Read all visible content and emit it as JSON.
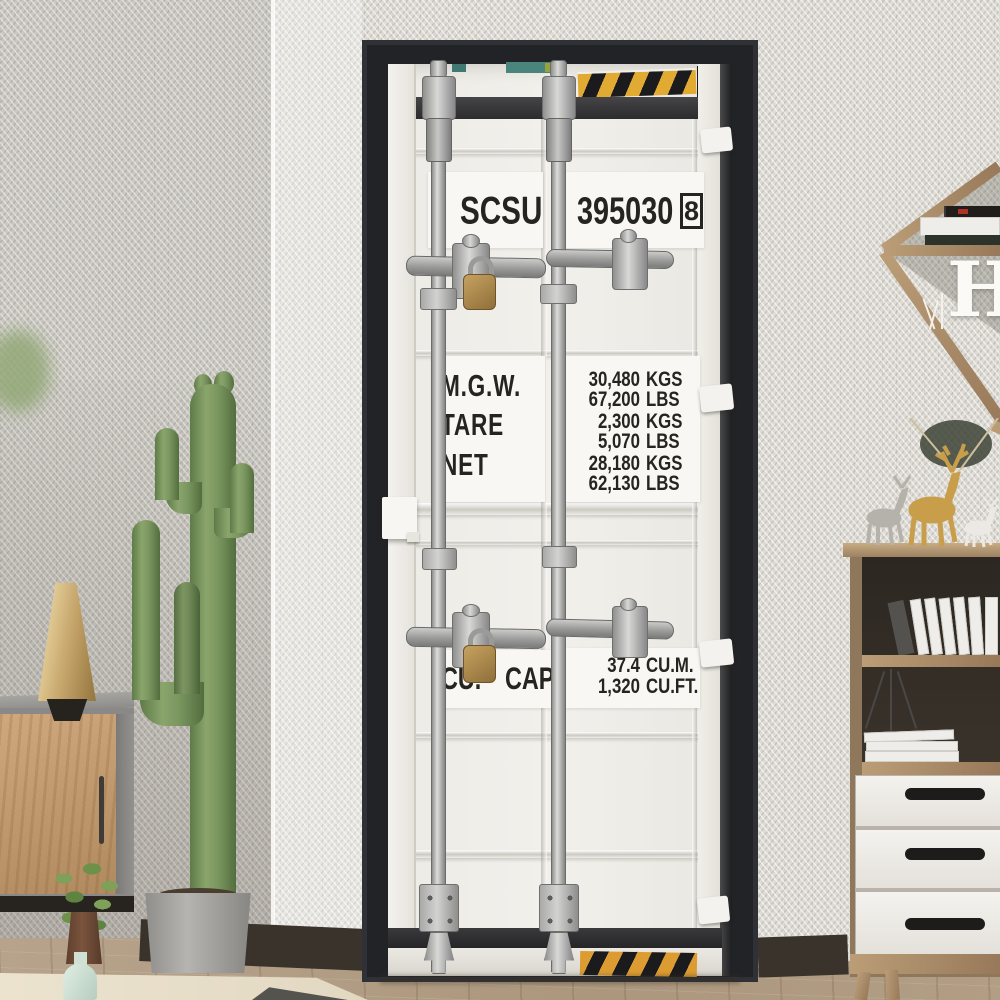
{
  "container_door": {
    "owner_code": "SCSU",
    "serial_number": "395030",
    "check_digit": "8",
    "weights": [
      {
        "label": "M.G.W.",
        "metric_value": "30,480",
        "metric_unit": "KGS",
        "imperial_value": "67,200",
        "imperial_unit": "LBS"
      },
      {
        "label": "TARE",
        "metric_value": "2,300",
        "metric_unit": "KGS",
        "imperial_value": "5,070",
        "imperial_unit": "LBS"
      },
      {
        "label": "NET",
        "metric_value": "28,180",
        "metric_unit": "KGS",
        "imperial_value": "62,130",
        "imperial_unit": "LBS"
      }
    ],
    "capacity": {
      "label": "CU. CAP.",
      "metric_value": "37.4",
      "metric_unit": "CU.M.",
      "imperial_value": "1,320",
      "imperial_unit": "CU.FT."
    }
  },
  "decor": {
    "shelf_letter": "H"
  },
  "colors": {
    "door_frame_black": "#222327",
    "container_white": "#eeece7",
    "warning_yellow": "#e0aa33",
    "warning_black": "#1b1b1e",
    "padlock_brass": "#a8824c",
    "cactus_green": "#7c9663",
    "gold_accent": "#c99e4b"
  }
}
